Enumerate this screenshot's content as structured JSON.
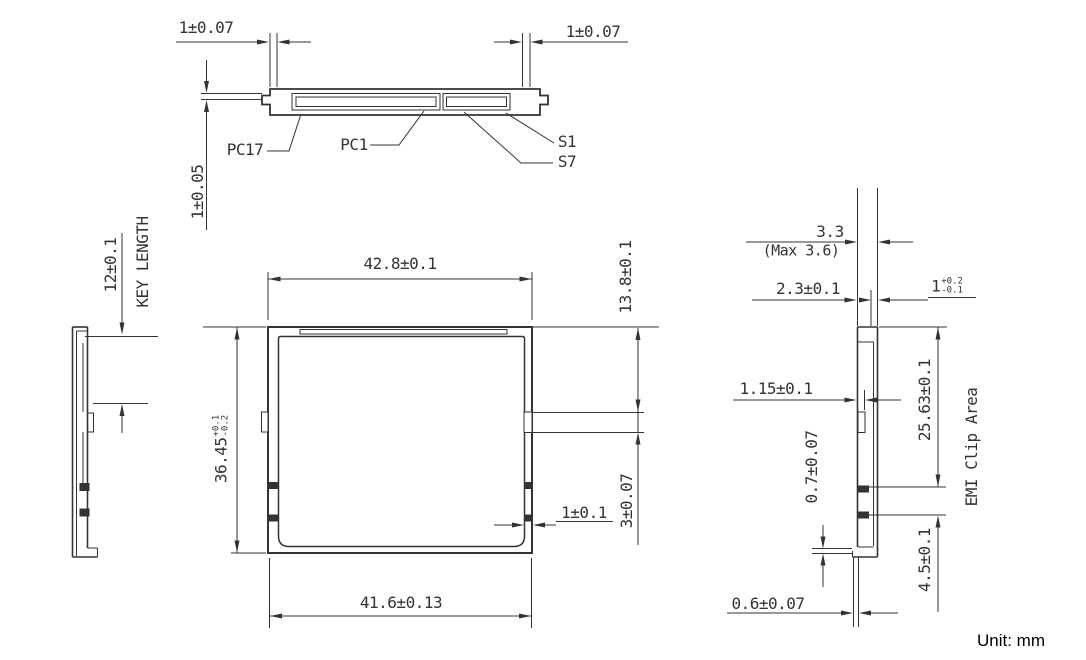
{
  "unit_label": "Unit: mm",
  "colors": {
    "line": "#333333",
    "text": "#333333"
  },
  "top_view": {
    "pin_labels": {
      "pc17": "PC17",
      "pc1": "PC1",
      "s1": "S1",
      "s7": "S7"
    },
    "dim_left_key_offset": "1±0.07",
    "dim_right_key_offset": "1±0.07",
    "dim_lip_thickness": "1±0.05"
  },
  "left_view": {
    "dim_key_length": "12±0.1",
    "key_length_label": "KEY LENGTH"
  },
  "front_view": {
    "dim_overall_width": "42.8±0.1",
    "dim_bottom_width": "41.6±0.13",
    "dim_overall_height": {
      "value": "36.45",
      "tol_plus": "+0.1",
      "tol_minus": "-0.2"
    },
    "dim_slot_from_top": "13.8±0.1",
    "dim_slot_height": "3±0.07",
    "dim_rail_width": "1±0.1"
  },
  "right_view": {
    "dim_thickness": "3.3",
    "dim_thickness_max": "(Max 3.6)",
    "dim_guide_width": "2.3±0.1",
    "dim_lip": {
      "value": "1",
      "tol_plus": "+0.2",
      "tol_minus": "-0.1"
    },
    "dim_step": "1.15±0.1",
    "dim_bottom_lip": "0.7±0.07",
    "dim_emi_clip_top": "25.63±0.1",
    "dim_emi_clip_height": "4.5±0.1",
    "emi_area_label": "EMI Clip Area",
    "dim_tab_width": "0.6±0.07"
  }
}
